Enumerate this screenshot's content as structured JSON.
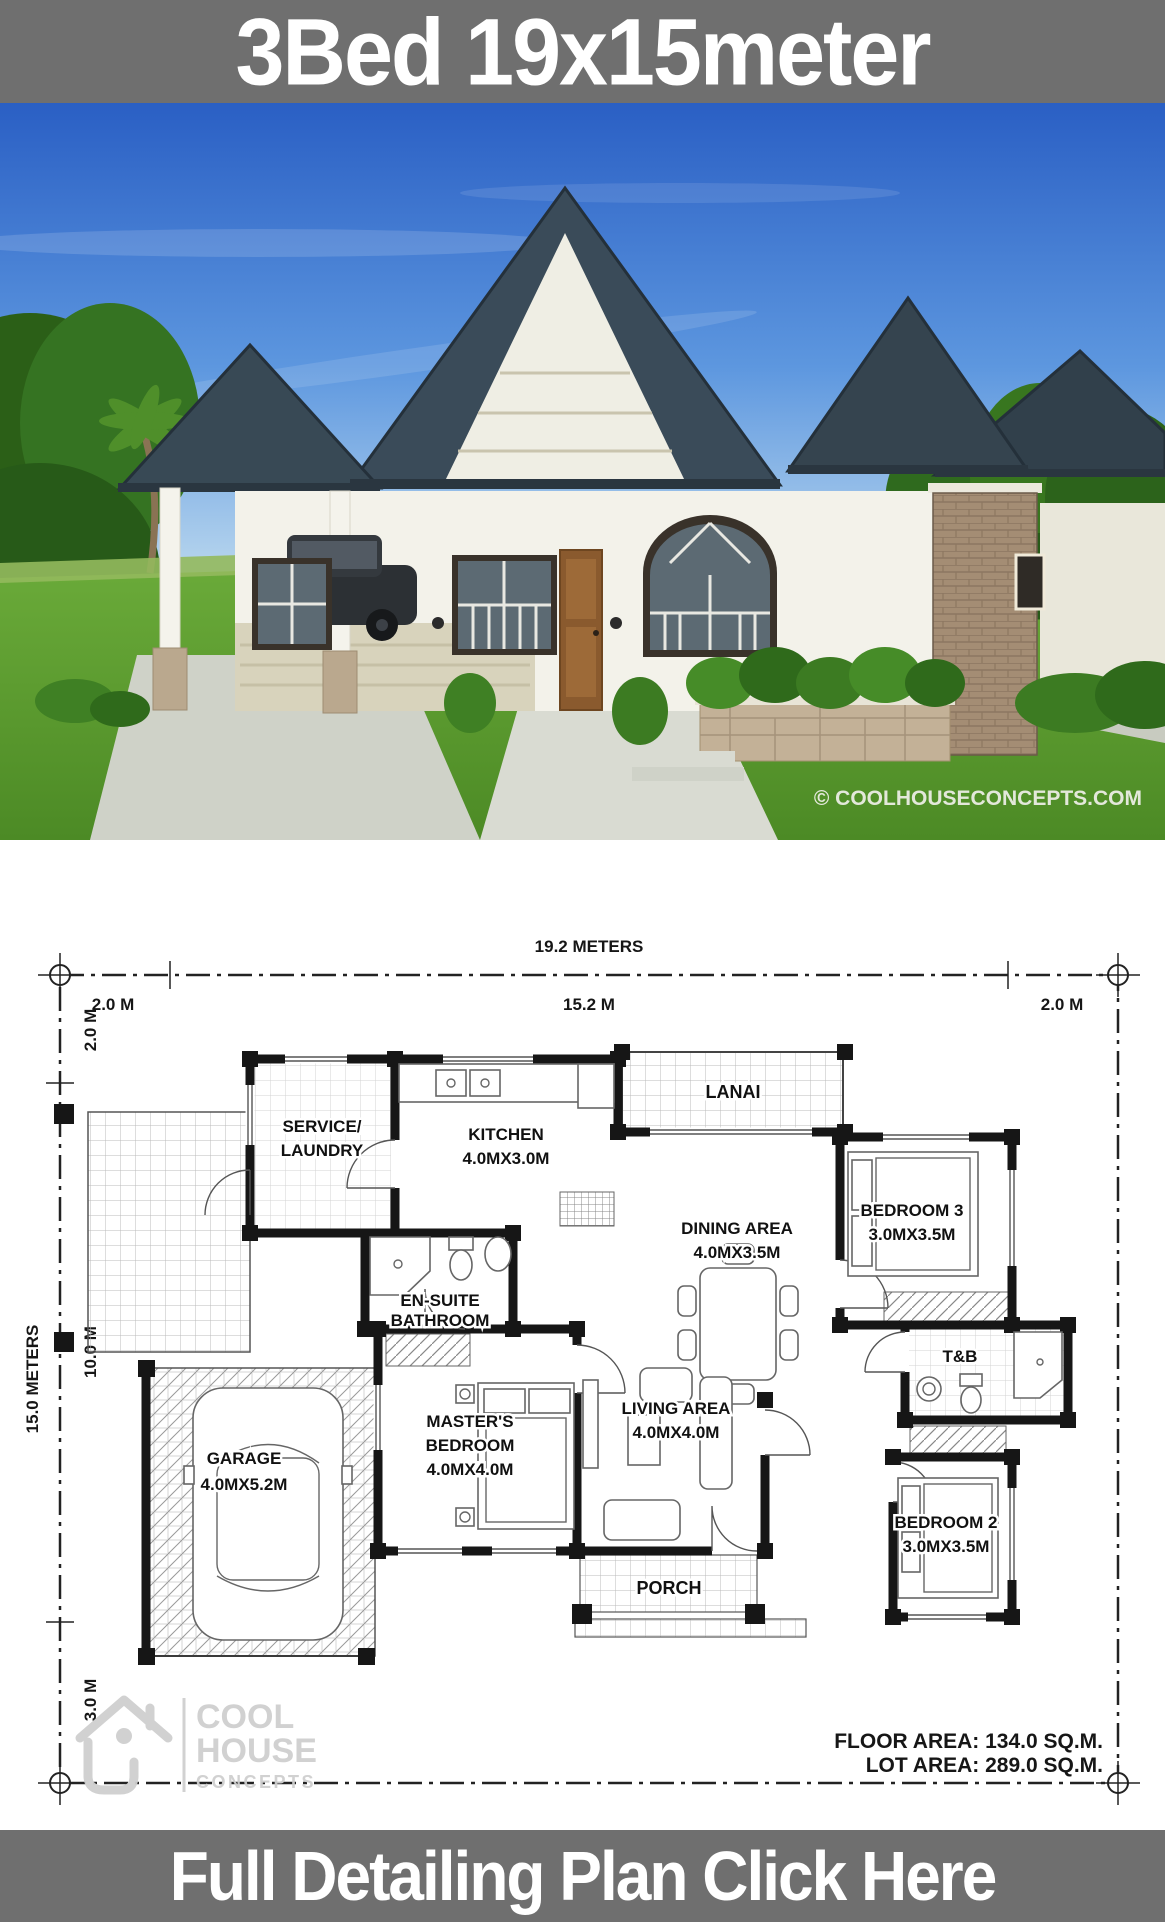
{
  "header": {
    "title": "3Bed 19x15meter"
  },
  "footer": {
    "cta": "Full Detailing Plan Click Here"
  },
  "photo": {
    "watermark": "© COOLHOUSECONCEPTS.COM"
  },
  "plan": {
    "dimensions": {
      "top_total": "19.2 METERS",
      "top_left": "2.0 M",
      "top_mid": "15.2 M",
      "top_right": "2.0 M",
      "left_total": "15.0 METERS",
      "left_top": "2.0 M",
      "left_mid": "10.0 M",
      "left_bottom": "3.0 M"
    },
    "rooms": {
      "service": {
        "l1": "SERVICE/",
        "l2": "LAUNDRY"
      },
      "kitchen": {
        "l1": "KITCHEN",
        "l2": "4.0MX3.0M"
      },
      "lanai": {
        "l1": "LANAI"
      },
      "dining": {
        "l1": "DINING AREA",
        "l2": "4.0MX3.5M"
      },
      "bedroom3": {
        "l1": "BEDROOM 3",
        "l2": "3.0MX3.5M"
      },
      "ensuite": {
        "l1": "EN-SUITE",
        "l2": "BATHROOM"
      },
      "tb": {
        "l1": "T&B"
      },
      "garage": {
        "l1": "GARAGE",
        "l2": "4.0MX5.2M"
      },
      "master": {
        "l1": "MASTER'S",
        "l2": "BEDROOM",
        "l3": "4.0MX4.0M"
      },
      "living": {
        "l1": "LIVING AREA",
        "l2": "4.0MX4.0M"
      },
      "bedroom2": {
        "l1": "BEDROOM 2",
        "l2": "3.0MX3.5M"
      },
      "porch": {
        "l1": "PORCH"
      }
    },
    "areas": {
      "floor": "FLOOR AREA: 134.0 SQ.M.",
      "lot": "LOT AREA: 289.0 SQ.M."
    },
    "logo": {
      "line1": "COOL",
      "line2": "HOUSE",
      "line3": "CONCEPTS"
    }
  },
  "colors": {
    "bar_gray": "#6f6f6f",
    "sky_blue": "#2a5fc4",
    "grass_green": "#5ea32e",
    "roof_slate": "#3a4b59",
    "plan_line": "#161616"
  }
}
